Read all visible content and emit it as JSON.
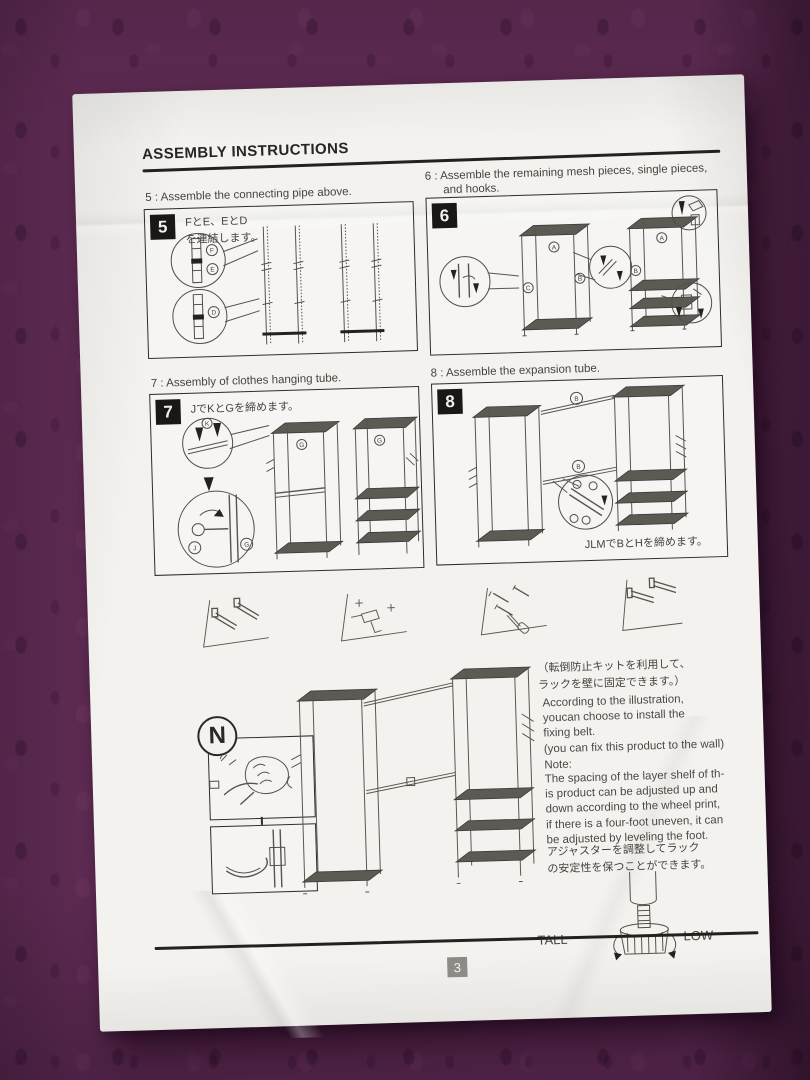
{
  "header": {
    "title": "ASSEMBLY INSTRUCTIONS"
  },
  "steps": {
    "s5": {
      "num": "5",
      "caption": "5 : Assemble the connecting pipe above.",
      "jp": "FとE、EとD\nを連結します。",
      "label_f": "F",
      "label_e": "E",
      "label_d": "D"
    },
    "s6": {
      "num": "6",
      "caption_line1": "6 : Assemble the remaining mesh pieces, single pieces,",
      "caption_line2": "and hooks.",
      "label_a": "A",
      "label_b": "B",
      "label_c": "C"
    },
    "s7": {
      "num": "7",
      "caption": "7 : Assembly of clothes hanging tube.",
      "jp": "JでKとGを締めます。",
      "label_k": "K",
      "label_g": "G",
      "label_j": "J"
    },
    "s8": {
      "num": "8",
      "caption": "8 : Assemble the expansion tube.",
      "jp": "JLMでBとHを締めます。",
      "label_b_top": "B",
      "label_b_mid": "B"
    }
  },
  "notes": {
    "wall_jp": "（転倒防止キットを利用して、\nラックを壁に固定できます。）",
    "wall_en": "According to the illustration,\nyoucan choose to install the\nfixing belt.\n(you can fix this product to the wall)",
    "note_label": "Note:",
    "note_body": "The spacing of the layer shelf of th-\nis product can be adjusted up and\ndown according to the wheel print,\nif there is a four-foot uneven, it can\nbe adjusted by leveling the foot.",
    "adjuster_jp": "アジャスターを調整してラック\nの安定性を保つことができます。",
    "n_label": "N",
    "tall": "TALL",
    "low": "LOW"
  },
  "footer": {
    "page_number": "3"
  }
}
